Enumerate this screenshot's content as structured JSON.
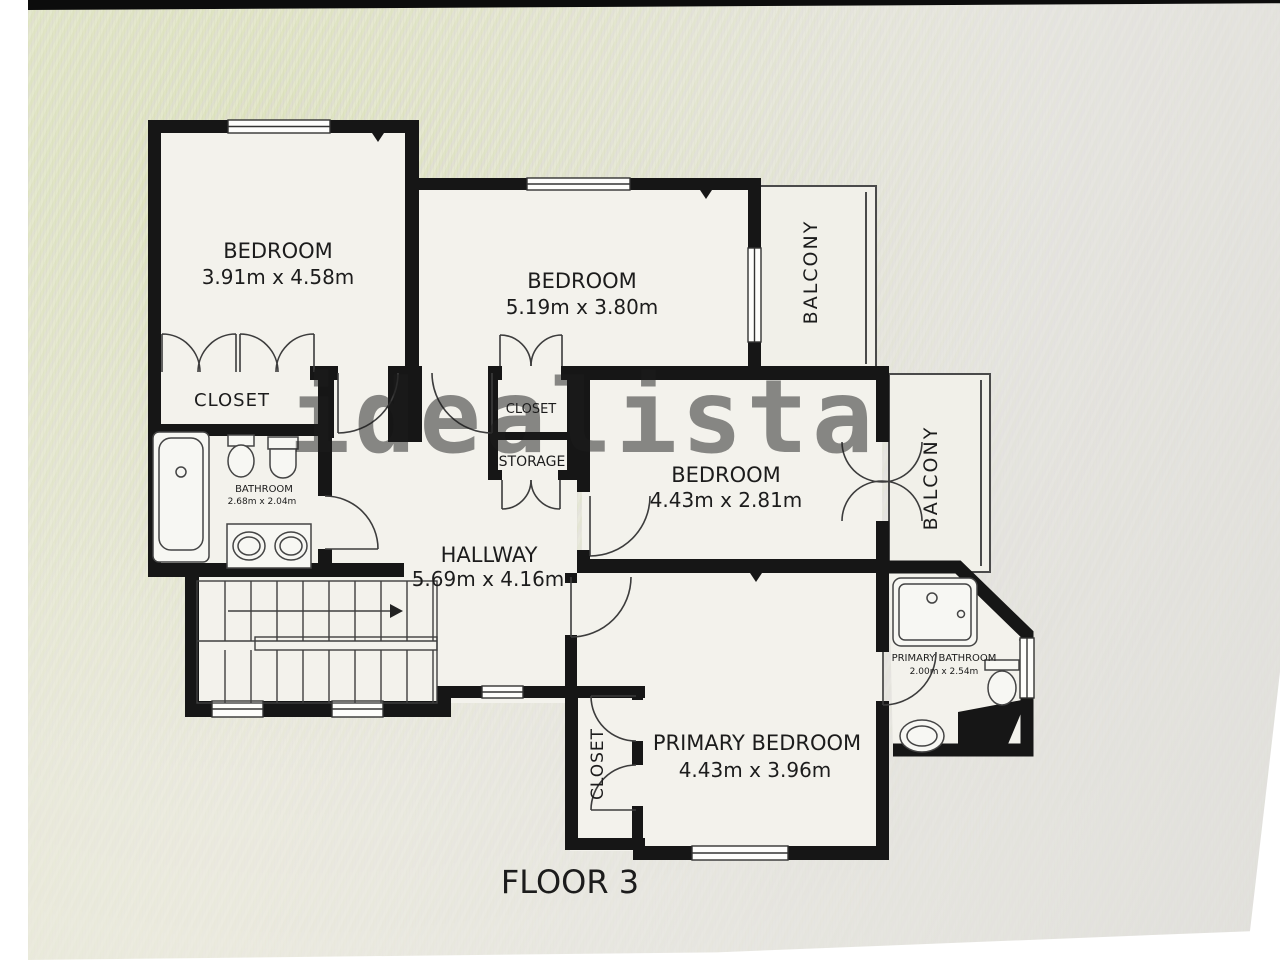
{
  "floorplan": {
    "floor_label": "FLOOR 3",
    "watermark": "idealista",
    "colors": {
      "wall": "#161616",
      "floor": "#f3f2ec",
      "label": "#1c1c1c",
      "watermark": "#8f8f8f"
    },
    "rooms": {
      "bedroom_top_left": {
        "name": "BEDROOM",
        "dims": "3.91m x 4.58m"
      },
      "bedroom_top_middle": {
        "name": "BEDROOM",
        "dims": "5.19m x 3.80m"
      },
      "bedroom_middle_right": {
        "name": "BEDROOM",
        "dims": "4.43m x 2.81m"
      },
      "primary_bedroom": {
        "name": "PRIMARY BEDROOM",
        "dims": "4.43m x 3.96m"
      },
      "hallway": {
        "name": "HALLWAY",
        "dims": "5.69m x 4.16m"
      },
      "bathroom": {
        "name": "BATHROOM",
        "dims": "2.68m x 2.04m"
      },
      "primary_bathroom": {
        "name": "PRIMARY BATHROOM",
        "dims": "2.00m x 2.54m"
      },
      "closet_bedroom1": {
        "name": "CLOSET"
      },
      "closet_center": {
        "name": "CLOSET"
      },
      "storage": {
        "name": "STORAGE"
      },
      "closet_primary": {
        "name": "CLOSET"
      },
      "balcony_top": {
        "name": "BALCONY"
      },
      "balcony_right": {
        "name": "BALCONY"
      }
    }
  }
}
